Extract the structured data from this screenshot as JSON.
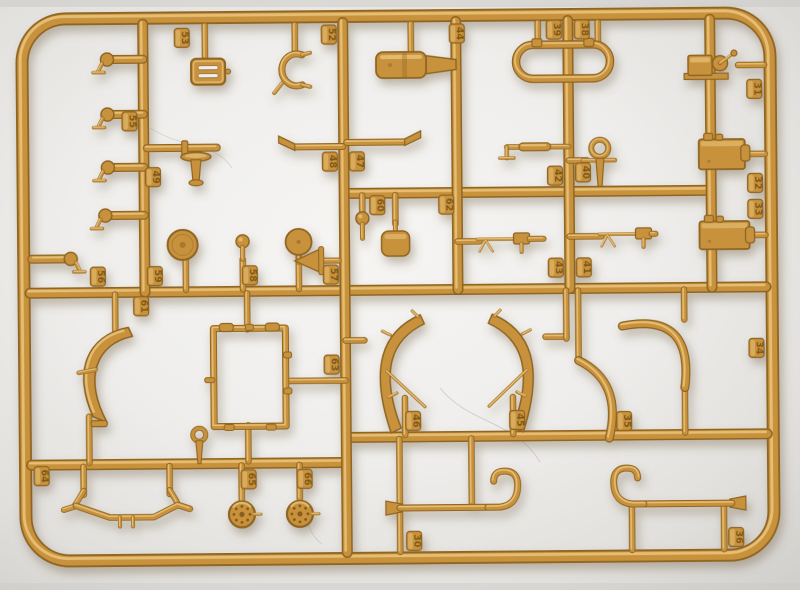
{
  "subject": "sand-yellow injection-molded model kit sprue photographed on light background",
  "palette": {
    "background_center": "#f6f5f3",
    "background_edge": "#d2d0cd",
    "plastic_base": "#C8923E",
    "plastic_light": "#E9C379",
    "plastic_dark": "#8F6524",
    "emboss_text": "#7d5714",
    "cast_shadow": "#6b5a3a"
  },
  "frame": {
    "x": 24,
    "y": 16,
    "w": 748,
    "h": 542,
    "r": 44,
    "t": 13
  },
  "runners": [
    [
      30,
      290,
      766,
      290
    ],
    [
      345,
      193,
      712,
      193
    ],
    [
      345,
      437,
      766,
      437
    ],
    [
      30,
      462,
      345,
      462
    ],
    [
      145,
      22,
      145,
      290
    ],
    [
      345,
      22,
      345,
      552
    ],
    [
      458,
      22,
      458,
      290
    ],
    [
      570,
      22,
      570,
      290
    ],
    [
      712,
      22,
      712,
      290
    ]
  ],
  "stubs": [
    [
      207,
      24,
      207,
      56
    ],
    [
      297,
      24,
      297,
      50
    ],
    [
      413,
      24,
      413,
      54
    ],
    [
      540,
      24,
      540,
      46
    ],
    [
      600,
      24,
      600,
      46
    ],
    [
      740,
      68,
      766,
      68
    ],
    [
      186,
      252,
      186,
      288
    ],
    [
      299,
      256,
      299,
      288
    ],
    [
      243,
      258,
      243,
      288
    ],
    [
      363,
      195,
      363,
      214
    ],
    [
      396,
      195,
      396,
      224
    ],
    [
      458,
      242,
      480,
      242
    ],
    [
      570,
      238,
      602,
      238
    ],
    [
      748,
      157,
      766,
      157
    ],
    [
      748,
      238,
      766,
      238
    ],
    [
      570,
      162,
      588,
      162
    ],
    [
      115,
      292,
      115,
      330
    ],
    [
      88,
      414,
      88,
      460
    ],
    [
      247,
      292,
      247,
      328
    ],
    [
      247,
      424,
      247,
      460
    ],
    [
      287,
      380,
      345,
      380
    ],
    [
      345,
      340,
      364,
      340
    ],
    [
      545,
      338,
      566,
      338
    ],
    [
      566,
      292,
      566,
      340
    ],
    [
      404,
      398,
      404,
      435
    ],
    [
      512,
      398,
      512,
      435
    ],
    [
      684,
      292,
      684,
      322
    ],
    [
      684,
      386,
      684,
      435
    ],
    [
      578,
      292,
      578,
      362
    ],
    [
      82,
      464,
      82,
      492
    ],
    [
      168,
      464,
      168,
      492
    ],
    [
      240,
      464,
      240,
      500
    ],
    [
      298,
      464,
      298,
      498
    ],
    [
      398,
      439,
      398,
      504
    ],
    [
      470,
      439,
      470,
      504
    ],
    [
      398,
      510,
      398,
      552
    ],
    [
      630,
      506,
      630,
      552
    ],
    [
      722,
      506,
      722,
      552
    ]
  ],
  "tags": [
    {
      "n": "53",
      "x": 184,
      "y": 36
    },
    {
      "n": "52",
      "x": 331,
      "y": 34
    },
    {
      "n": "44",
      "x": 459,
      "y": 34
    },
    {
      "n": "39",
      "x": 556,
      "y": 31
    },
    {
      "n": "38",
      "x": 584,
      "y": 31
    },
    {
      "n": "31",
      "x": 756,
      "y": 92
    },
    {
      "n": "32",
      "x": 756,
      "y": 186
    },
    {
      "n": "33",
      "x": 756,
      "y": 212
    },
    {
      "n": "34",
      "x": 756,
      "y": 351
    },
    {
      "n": "55",
      "x": 131,
      "y": 119
    },
    {
      "n": "49",
      "x": 154,
      "y": 175
    },
    {
      "n": "48",
      "x": 331,
      "y": 161
    },
    {
      "n": "47",
      "x": 358,
      "y": 161
    },
    {
      "n": "42",
      "x": 556,
      "y": 177
    },
    {
      "n": "40",
      "x": 584,
      "y": 174
    },
    {
      "n": "43",
      "x": 556,
      "y": 269
    },
    {
      "n": "41",
      "x": 584,
      "y": 269
    },
    {
      "n": "56",
      "x": 98,
      "y": 274
    },
    {
      "n": "59",
      "x": 155,
      "y": 274
    },
    {
      "n": "58",
      "x": 250,
      "y": 274
    },
    {
      "n": "57",
      "x": 331,
      "y": 274
    },
    {
      "n": "60",
      "x": 378,
      "y": 205
    },
    {
      "n": "62",
      "x": 447,
      "y": 205
    },
    {
      "n": "61",
      "x": 141,
      "y": 304
    },
    {
      "n": "63",
      "x": 331,
      "y": 364
    },
    {
      "n": "46",
      "x": 412,
      "y": 421
    },
    {
      "n": "45",
      "x": 516,
      "y": 421
    },
    {
      "n": "35",
      "x": 623,
      "y": 423
    },
    {
      "n": "36",
      "x": 734,
      "y": 540
    },
    {
      "n": "64",
      "x": 40,
      "y": 473
    },
    {
      "n": "65",
      "x": 247,
      "y": 478
    },
    {
      "n": "66",
      "x": 303,
      "y": 478
    },
    {
      "n": "30",
      "x": 412,
      "y": 541
    }
  ],
  "parts": [
    {
      "t": "grille",
      "n": "radiator-grille-part",
      "x": 193,
      "y": 57,
      "w": 34,
      "h": 26
    },
    {
      "t": "hookbolt",
      "n": "towing-hook-part",
      "x": 93,
      "y": 57,
      "w": 52
    },
    {
      "t": "hookbolt",
      "n": "towing-hook-part",
      "x": 93,
      "y": 112,
      "w": 52
    },
    {
      "t": "hookbolt",
      "n": "towing-hook-part",
      "x": 93,
      "y": 165,
      "w": 52
    },
    {
      "t": "hookbolt",
      "n": "towing-hook-part",
      "x": 90,
      "y": 213,
      "w": 55
    },
    {
      "t": "hookbolt",
      "n": "towing-hook-part",
      "x": 32,
      "y": 256,
      "w": 55,
      "f": "m"
    },
    {
      "t": "clamp",
      "n": "clamp-bracket-part",
      "x": 278,
      "y": 50,
      "w": 32,
      "h": 38
    },
    {
      "t": "cylinder",
      "n": "fuel-tank-part",
      "x": 378,
      "y": 52,
      "w": 50,
      "h": 26
    },
    {
      "t": "loop",
      "n": "tow-loop-part",
      "x": 518,
      "y": 46,
      "w": 94,
      "h": 34
    },
    {
      "t": "winch",
      "n": "winch-part",
      "x": 686,
      "y": 52,
      "w": 54,
      "h": 32
    },
    {
      "t": "rodflange",
      "n": "axle-rod-part",
      "x": 148,
      "y": 139,
      "w": 70
    },
    {
      "t": "mushroom",
      "n": "air-filter-part",
      "x": 182,
      "y": 150,
      "w": 30,
      "h": 34
    },
    {
      "t": "funnelpipe",
      "n": "exhaust-pipe-part",
      "x": 282,
      "y": 134,
      "w": 62,
      "f": "l"
    },
    {
      "t": "funnelpipe",
      "n": "exhaust-pipe-part",
      "x": 348,
      "y": 130,
      "w": 72,
      "f": "r"
    },
    {
      "t": "lever",
      "n": "crank-handle-part",
      "x": 492,
      "y": 142,
      "w": 78
    },
    {
      "t": "shackle",
      "n": "shackle-pin-part",
      "x": 588,
      "y": 140,
      "w": 26,
      "h": 48
    },
    {
      "t": "ballstud",
      "n": "ball-stud-part",
      "x": 352,
      "y": 212,
      "w": 22,
      "h": 26
    },
    {
      "t": "pad",
      "n": "seat-pad-part",
      "x": 382,
      "y": 222,
      "w": 28,
      "h": 34
    },
    {
      "t": "pulley",
      "n": "pulley-wheel-part",
      "x": 168,
      "y": 228,
      "w": 30
    },
    {
      "t": "disc",
      "n": "idler-disc-part",
      "x": 286,
      "y": 228,
      "w": 26
    },
    {
      "t": "ballstud",
      "n": "knob-post-part",
      "x": 233,
      "y": 234,
      "w": 20,
      "h": 24
    },
    {
      "t": "arrowcone",
      "n": "horn-part",
      "x": 295,
      "y": 248,
      "w": 44,
      "h": 24
    },
    {
      "t": "gun",
      "n": "machine-gun-part",
      "x": 478,
      "y": 230,
      "w": 66,
      "f": "l"
    },
    {
      "t": "gun",
      "n": "machine-gun-part",
      "x": 600,
      "y": 226,
      "w": 56,
      "f": "r"
    },
    {
      "t": "block",
      "n": "engine-block-part",
      "x": 700,
      "y": 142,
      "w": 46,
      "h": 30
    },
    {
      "t": "block",
      "n": "engine-block-part",
      "x": 700,
      "y": 224,
      "w": 50,
      "h": 28
    },
    {
      "t": "bigfender",
      "n": "front-fender-part",
      "x": 76,
      "y": 325,
      "w": 62,
      "h": 95
    },
    {
      "t": "framerect",
      "n": "windshield-frame-part",
      "x": 213,
      "y": 327,
      "w": 72,
      "h": 98
    },
    {
      "t": "crescent",
      "n": "fender-part",
      "x": 362,
      "y": 315,
      "w": 72,
      "h": 118
    },
    {
      "t": "crescent",
      "n": "fender-part",
      "x": 478,
      "y": 315,
      "w": 72,
      "h": 118,
      "f": "m"
    },
    {
      "t": "qarc",
      "n": "fender-brace-part",
      "x": 616,
      "y": 318,
      "w": 80,
      "h": 72,
      "f": "a"
    },
    {
      "t": "qarc",
      "n": "fender-brace-part",
      "x": 566,
      "y": 366,
      "w": 48,
      "h": 74,
      "f": "b"
    },
    {
      "t": "swaybar",
      "n": "tow-hitch-bar-part",
      "x": 64,
      "y": 488,
      "w": 124
    },
    {
      "t": "wheel",
      "n": "hub-cap-part",
      "x": 227,
      "y": 500,
      "w": 26
    },
    {
      "t": "wheel",
      "n": "hub-cap-part",
      "x": 285,
      "y": 500,
      "w": 26
    },
    {
      "t": "cane",
      "n": "grab-rail-part",
      "x": 384,
      "y": 470,
      "w": 138
    },
    {
      "t": "cane",
      "n": "grab-rail-part",
      "x": 610,
      "y": 468,
      "w": 134,
      "f": "m"
    },
    {
      "t": "eyebolt",
      "n": "eye-bolt-part",
      "x": 188,
      "y": 426,
      "w": 20,
      "h": 36
    }
  ]
}
